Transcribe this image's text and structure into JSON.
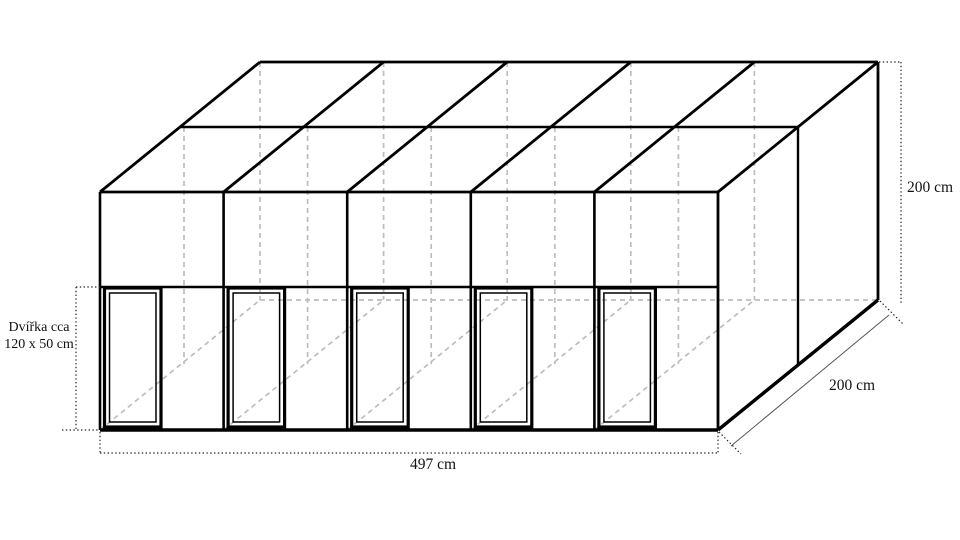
{
  "labels": {
    "door_note_line1": "Dvířka cca",
    "door_note_line2": "120 x 50 cm",
    "width": "497 cm",
    "height": "200 cm",
    "depth": "200 cm"
  },
  "structure": {
    "compartments": 5,
    "doors": 5,
    "roof_panel_rows": 2,
    "roof_panel_columns": 5
  },
  "colors": {
    "outline": "#000000",
    "hidden_edge": "#bdbdbd",
    "dimension_line": "#222222",
    "text": "#111111",
    "background": "#ffffff"
  }
}
